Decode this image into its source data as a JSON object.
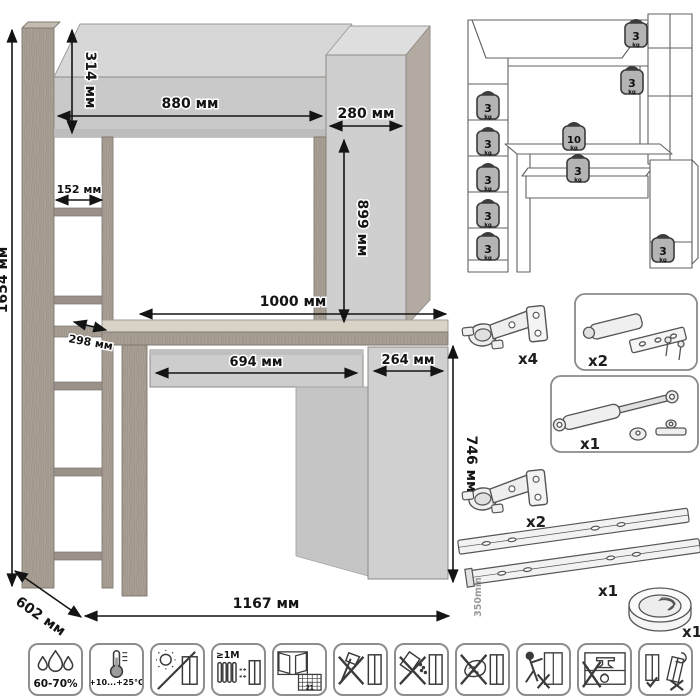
{
  "colors": {
    "background": "#ffffff",
    "panel_grey": "#c9c9c9",
    "panel_light": "#d9d9d9",
    "wood_grey": "#a89f95",
    "outline_grey": "#8f8a84",
    "dimension_text": "#141414",
    "hardware_line": "#555555",
    "icon_line": "#3b3b3b",
    "weight_fill": "#b4b4b4"
  },
  "main_drawing": {
    "unit": "мм",
    "dims": {
      "total_height": "1654 мм",
      "hutch_height": "314 мм",
      "hutch_width": "880 мм",
      "top_right_width": "280 мм",
      "right_column_height": "899 мм",
      "shelf_width": "152 мм",
      "shelf_depth": "298 мм",
      "desktop_width": "1000 мм",
      "drawer_width": "694 мм",
      "door_width": "264 мм",
      "desk_height": "746 мм",
      "depth": "602 мм",
      "total_width": "1167 мм"
    }
  },
  "load_diagram": {
    "weights": [
      {
        "value": "3",
        "unit": "kg",
        "location": "hutch-top-right"
      },
      {
        "value": "3",
        "unit": "kg",
        "location": "right-column-shelf"
      },
      {
        "value": "3",
        "unit": "kg",
        "location": "left-shelf-1"
      },
      {
        "value": "3",
        "unit": "kg",
        "location": "left-shelf-2"
      },
      {
        "value": "10",
        "unit": "kg",
        "location": "desktop"
      },
      {
        "value": "3",
        "unit": "kg",
        "location": "drawer"
      },
      {
        "value": "3",
        "unit": "kg",
        "location": "left-shelf-3"
      },
      {
        "value": "3",
        "unit": "kg",
        "location": "left-shelf-4"
      },
      {
        "value": "3",
        "unit": "kg",
        "location": "left-shelf-5"
      },
      {
        "value": "3",
        "unit": "kg",
        "location": "cabinet-shelf"
      }
    ]
  },
  "hardware": {
    "items": [
      {
        "name": "concealed hinge",
        "qty": "x4"
      },
      {
        "name": "push latch with plate and screws",
        "qty": "x2"
      },
      {
        "name": "gas strut with brackets",
        "qty": "x1"
      },
      {
        "name": "concealed hinge",
        "qty": "x2"
      },
      {
        "name": "drawer slides",
        "qty": "x1",
        "length": "350mm"
      },
      {
        "name": "cable grommet",
        "qty": "x1"
      }
    ]
  },
  "care_icons": [
    {
      "name": "humidity",
      "label": "60-70%"
    },
    {
      "name": "temperature",
      "label": "+10...+25°C"
    },
    {
      "name": "no-direct-sunlight",
      "label": ""
    },
    {
      "name": "heat-distance",
      "label": "≥1М"
    },
    {
      "name": "ventilation",
      "label": "21"
    },
    {
      "name": "no-impact",
      "label": ""
    },
    {
      "name": "no-abrasives",
      "label": ""
    },
    {
      "name": "no-wet-cleaning",
      "label": ""
    },
    {
      "name": "no-dragging",
      "label": ""
    },
    {
      "name": "no-overload",
      "label": ""
    },
    {
      "name": "level-placement",
      "label": ""
    }
  ]
}
